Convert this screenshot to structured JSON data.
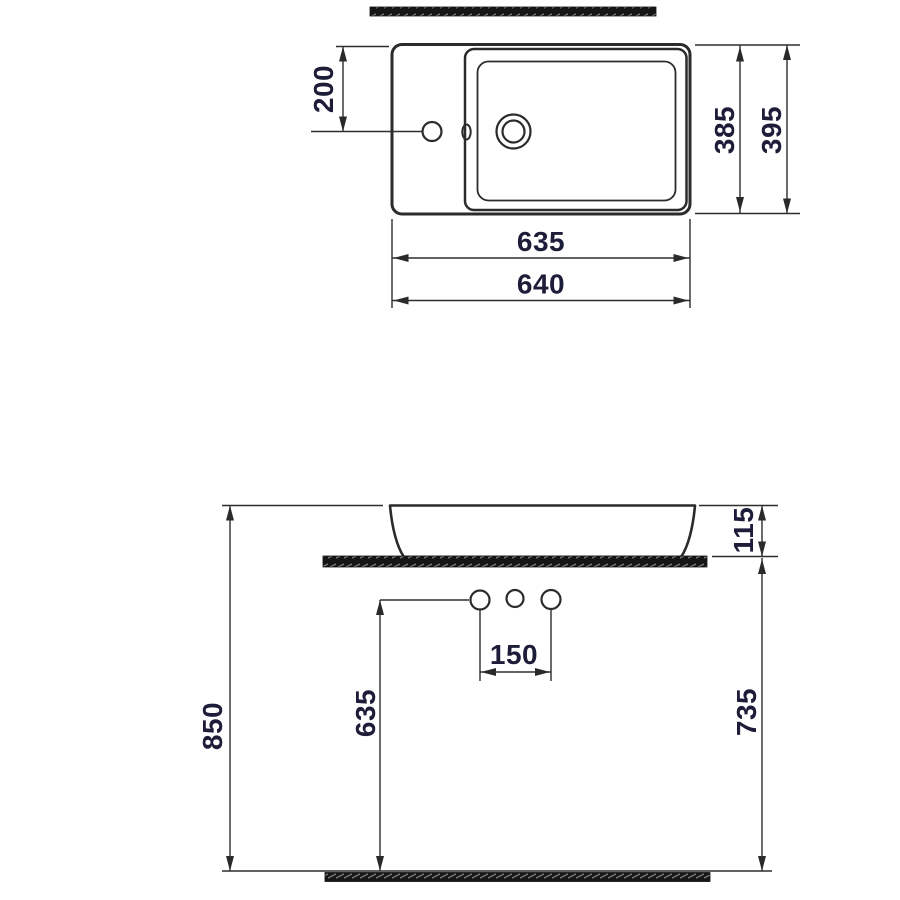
{
  "drawing": {
    "type": "washbasin-installation-dimensions",
    "colors": {
      "line": "#2b2b2b",
      "dimension_text": "#1d1d3a",
      "hatch_fill": "#161616",
      "hatch_tick": "#7d7d7d",
      "background": "#ffffff"
    },
    "plan_view": {
      "name": "top-view",
      "dims": {
        "faucet_offset_from_back": "200",
        "bowl_depth": "385",
        "overall_depth": "395",
        "bowl_width": "635",
        "overall_width": "640"
      }
    },
    "front_view": {
      "name": "front-elevation",
      "dims": {
        "overall_height": "850",
        "hole_height_from_floor": "635",
        "counter_height": "735",
        "hole_spacing": "150",
        "basin_rim_height": "115"
      }
    }
  }
}
